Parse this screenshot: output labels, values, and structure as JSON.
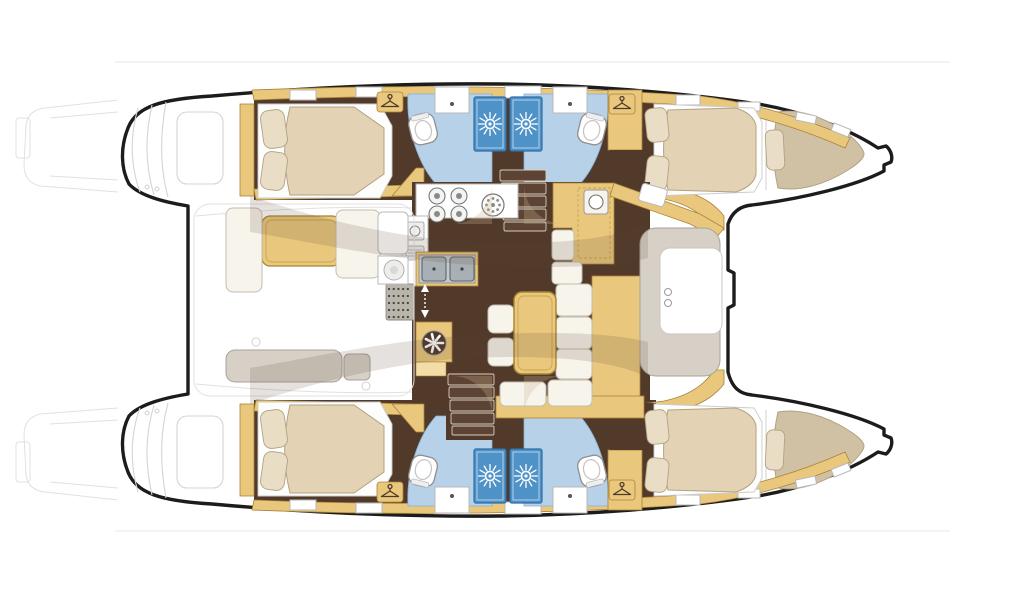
{
  "page": {
    "description": "Top-down interior floor plan of a sailing catamaran: two hulls with cabins and bathrooms, central salon and galley, aft cockpit with table, forward cockpit lounge, foredeck, bow points right",
    "bow_direction": "right",
    "stern_direction": "left",
    "background": "#ffffff"
  },
  "colors": {
    "outline": "#1c1c1c",
    "floor-dark": "#523a2b",
    "wood": "#e9c87d",
    "wood-light": "#f2dda6",
    "wood-dark": "#ab8338",
    "mattress": "#e3d2b4",
    "mattress-dark": "#d0c1a5",
    "mattress-stroke": "#b3a283",
    "pillow": "#e9ddc6",
    "bath-floor": "#b7d1e8",
    "bath-stroke": "#86aecf",
    "shower": "#4e92c8",
    "shower-dark": "#2e6ea6",
    "cushion": "#f7f4ec",
    "cushion-stroke": "#c3bdb0",
    "grey-seat": "#d6d0c7",
    "grey-seat-stroke": "#a8a39a",
    "steel": "#a8b0b5",
    "steel-dark": "#5f676b",
    "counter-stroke": "#b9b9b9",
    "stairs-tread": "#5c4333",
    "overlay": "#5d4430",
    "wedge": "#c9b38e"
  },
  "rooms": [
    {
      "id": "aft-cockpit",
      "label": "Aft cockpit with table and bench seating"
    },
    {
      "id": "salon",
      "label": "Salon with dining table, L-shaped sofa and stools"
    },
    {
      "id": "galley",
      "label": "Galley with 4-burner stove, round sink and twin sinks"
    },
    {
      "id": "nav-station",
      "label": "Forward-facing navigation station"
    },
    {
      "id": "port-hull",
      "label": "Port hull: aft double cabin, two shower rooms with toilets, forward double cabin, forepeak berth, transom swim steps"
    },
    {
      "id": "starboard-hull",
      "label": "Starboard hull: aft double cabin, two shower rooms with toilets, forward double cabin, forepeak berth, transom swim steps"
    },
    {
      "id": "foredeck-lounge",
      "label": "Forward cockpit lounge with cup holders"
    },
    {
      "id": "foredeck",
      "label": "Foredeck / trampoline area between the bows"
    }
  ],
  "fixtures": [
    {
      "id": "shower-icon",
      "label": "sunburst shower head"
    },
    {
      "id": "toilet-icon",
      "label": "toilet bowl"
    },
    {
      "id": "washbasin-icon",
      "label": "washbasin with tap dot"
    },
    {
      "id": "hanger-icon",
      "label": "clothes hanger wardrobe marker"
    },
    {
      "id": "stove-icon",
      "label": "four burner stove"
    },
    {
      "id": "round-sink-icon",
      "label": "round galley sink"
    },
    {
      "id": "double-sink-icon",
      "label": "stainless double sink"
    },
    {
      "id": "stairs-icon",
      "label": "companionway steps to hull"
    },
    {
      "id": "door-arrows-icon",
      "label": "sliding door direction arrows"
    },
    {
      "id": "mat-icon",
      "label": "dotted entry mat"
    },
    {
      "id": "fan-icon",
      "label": "round vent / table pedestal"
    },
    {
      "id": "cupholder-icon",
      "label": "cup holders"
    },
    {
      "id": "hatch-icon",
      "label": "deck hatch / skylight"
    }
  ]
}
